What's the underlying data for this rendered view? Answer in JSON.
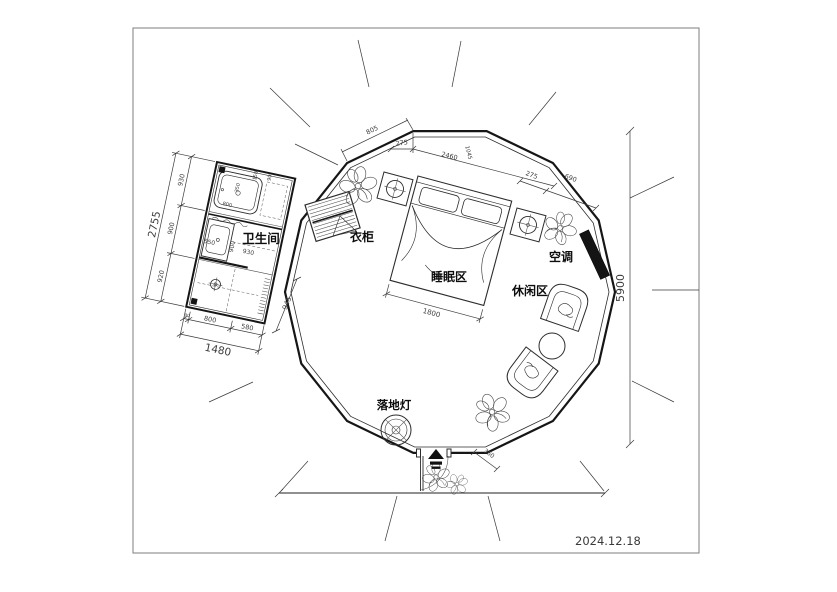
{
  "title_block": {
    "date": "2024.12.18"
  },
  "labels": {
    "bathroom": "卫生间",
    "wardrobe": "衣柜",
    "sleeping_area": "睡眠区",
    "leisure_area": "休闲区",
    "air_conditioner": "空调",
    "floor_lamp": "落地灯"
  },
  "dimensions": {
    "overall_height": "5900",
    "top_seg_805": "805",
    "top_seg_275": "275",
    "top_seg_2460": "2460",
    "top_seg_1045": "1045",
    "right_seg_275": "275",
    "right_seg_690": "690",
    "bed_width": "1800",
    "entry_step": "360",
    "bathroom": {
      "left_total": "2755",
      "left_segs": [
        "930",
        "900",
        "920"
      ],
      "bottom_total": "1480",
      "bottom_segs": [
        "90",
        "800",
        "580"
      ],
      "diag": "945",
      "sink": "550",
      "inner_900": "900",
      "inner_930": "930",
      "tub_800": "800",
      "tub_350": "350",
      "tub_150": "150",
      "tub_90": "90"
    }
  },
  "colors": {
    "wall": "#161616",
    "line": "#3a3a3a",
    "ac_fill": "#141414"
  }
}
